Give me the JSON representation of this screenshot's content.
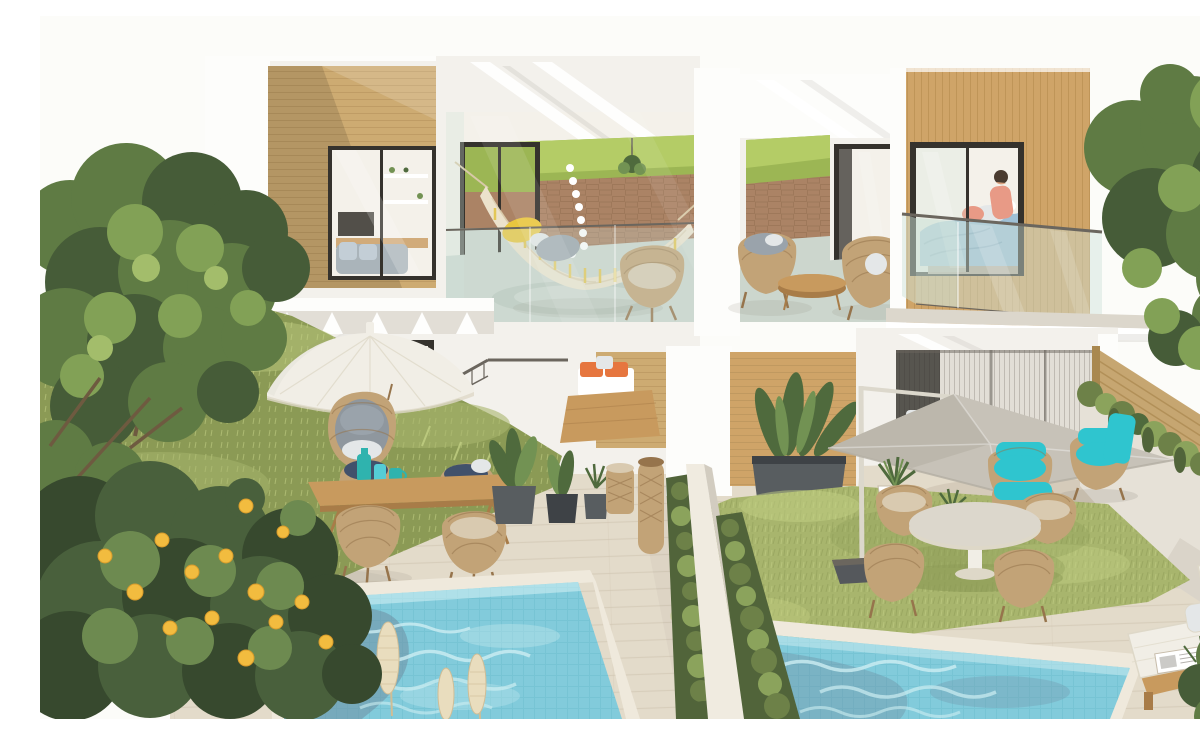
{
  "scene": {
    "title": "Photorealistic exterior rendering of twin modern two-storey villas with private gardens and plunge pools",
    "description": "Two attached white villas with timber cladding. Left unit: upstairs living room window and a glazed balcony holding a fringed hammock and a wicker chair; downstairs a patio with a white umbrella, hanging egg chair, wooden dining table with four wicker chairs and teal glass vases, potted plants and a rattan lamp beside a tiled plunge pool fronted by pampas grass and a lemon tree. Right unit: upstairs terrace with two wicker lounge chairs and a coffee table next to a timber-clad bedroom with blue bedding and a person sitting on the bed behind a glass balustrade; downstairs a lawn with a grey cantilever umbrella, a round table with four wicker chairs, lounge chairs with bright turquoise cushions, agave planters, a hedge-topped privacy wall, a timber fence with cascading plants, a second plunge pool and a white sun lounger. Mature green trees frame both sides under a bright white sky.",
    "objects": [
      "white duplex villa with timber cladding",
      "glazed balcony with fringed hammock and yellow cushion",
      "living-room window with shelves, TV and sofa",
      "upper terrace with two wicker lounge chairs and coffee table",
      "bedroom with blue bedding and seated person",
      "glass balustrades",
      "exterior wall lamp",
      "white patio umbrella",
      "hanging egg chair with grey cushions",
      "wooden dining table with four wicker chairs",
      "teal glass vases",
      "bench with orange cushions",
      "potted plants and rattan floor lamp",
      "grey cantilever umbrella with dark base",
      "round garden table with four wicker chairs",
      "lounge chairs with turquoise cushions",
      "agave planters",
      "lawn garden",
      "white privacy wall with hedges",
      "two plunge pools with mosaic tiles",
      "pampas grass plumes",
      "lemon tree with yellow fruit",
      "mature trees",
      "timber fence with cascading plants",
      "sun lounger with white cushions and magazine"
    ]
  },
  "palette": {
    "sky": "#fcfcf9",
    "facade": "#f3f1ec",
    "facadeBright": "#fdfdfb",
    "facadeShade": "#e2ded6",
    "shadow": "#8c867c",
    "woodL": "#cdab72",
    "woodLline": "#b28d58",
    "woodR": "#cfa468",
    "woodRline": "#b08648",
    "frame": "#35322d",
    "glass": "#cfe3da",
    "reflect": "#ffffff",
    "intWall": "#f4f1ea",
    "lawnBack": "#9cb654",
    "lawnBack2": "#b4cc66",
    "stone": "#ab8365",
    "stoneLine": "#8f6a4e",
    "bfloor": "#ccd6cd",
    "bfloorSh": "#b2c0b6",
    "hammock": "#ece2cc",
    "hammockSh": "#d8c9a8",
    "fringe": "#e3c757",
    "cushYellow": "#e9c63f",
    "cushGray": "#9aa3ab",
    "wicker": "#c2a377",
    "wickerD": "#96744c",
    "cushNavy": "#41516b",
    "cushBeige": "#d9cab0",
    "pillowLight": "#e4e7e8",
    "sofa": "#aab4ba",
    "sofaCush": "#c3ced6",
    "duvet": "#9fc0d6",
    "duvetD": "#7fa3bd",
    "bedBase": "#b5a898",
    "salmon": "#e89a86",
    "skin": "#d9a17e",
    "hair": "#4a3c30",
    "eggCush": "#8f979e",
    "umbWhite": "#f1eee6",
    "umbWhiteD": "#ded8c8",
    "umbGray": "#c7c2b8",
    "umbGrayD": "#b3aea3",
    "poleW": "#dcd8cc",
    "umbBase": "#55585c",
    "teal": "#2fc5cf",
    "tealD": "#1ea8b4",
    "orange": "#e6763f",
    "vase1": "#2fb3ae",
    "vase2": "#54cdd6",
    "tableWood": "#c89a5e",
    "tableWoodD": "#a87c48",
    "deck": "#e3dbca",
    "deckLine": "#cdc3ae",
    "deckShade": "#c7bcaa",
    "grass": "#a8b56d",
    "grassL": "#c2cf83",
    "grassD": "#8b9a55",
    "hedge": "#6d8148",
    "hedgeD": "#51643a",
    "hedgeL": "#8ba35c",
    "water": "#82cbdb",
    "waterHi": "#cdeef2",
    "waterSh": "#6f8fa3",
    "tileLine": "#62b7c6",
    "coping": "#efe9dc",
    "lemonleaf": "#49603c",
    "lemonleafD": "#37492e",
    "lemonleafL": "#6d8a50",
    "lemon": "#f2bc3f",
    "lemonEdge": "#d99c2b",
    "treeD": "#465c38",
    "treeM": "#5f7b44",
    "treeL": "#82a156",
    "treeXL": "#a3bd6b",
    "trunk": "#6e5a40",
    "fence": "#c6a671",
    "fenceLine": "#a9884f",
    "rwall": "#e6e1d7",
    "rwallSh": "#d2ccc0",
    "divider": "#f0ebe0",
    "pampas": "#e9ddbe",
    "pampasD": "#cfbd96",
    "planter": "#585d60",
    "planterD": "#3e4246",
    "plant": "#4f6a3d",
    "plantL": "#729253",
    "slab": "#dcd7cc",
    "metal": "#6b665e",
    "white": "#ffffff",
    "curtain": "#eceae4",
    "floorIn": "#d8cdbc",
    "roofB": "#8f6140"
  }
}
